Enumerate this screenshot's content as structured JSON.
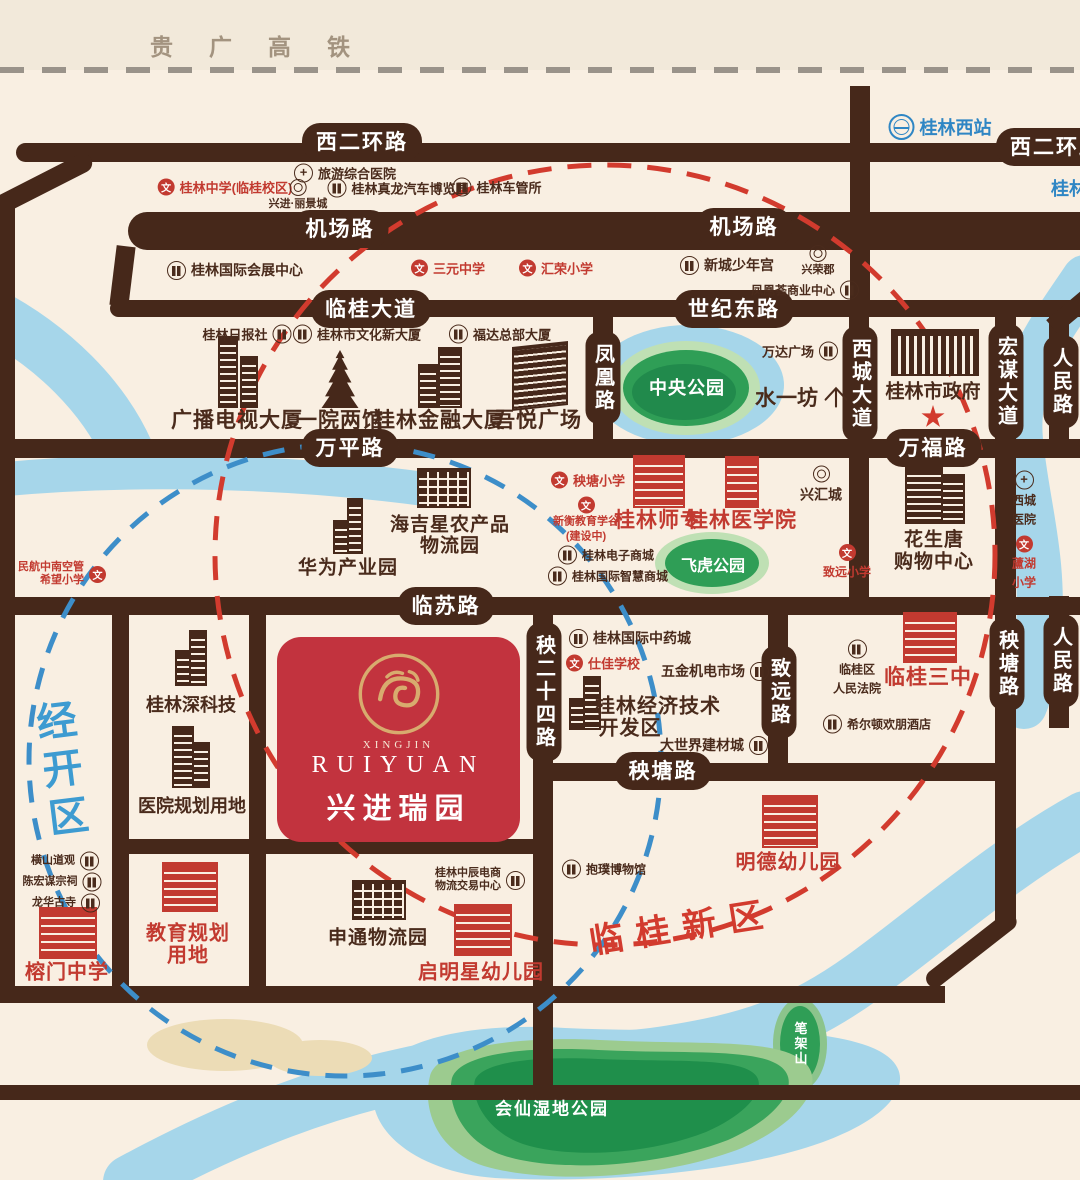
{
  "header": {
    "railway": "贵广高铁"
  },
  "station": {
    "west": "桂林西站",
    "city_clip": "桂林"
  },
  "roads": {
    "xierhuan": "西二环路",
    "xierhuan2": "西二环路",
    "jichang": "机场路",
    "jichang2": "机场路",
    "linguidadao": "临桂大道",
    "shijidong": "世纪东路",
    "wanping": "万平路",
    "wanfu": "万福路",
    "linsu": "临苏路",
    "yangtang": "秧塘路",
    "yangtang_v": "秧塘路",
    "fenghuang": "凤凰路",
    "xichengdadao": "西城大道",
    "hongmoudadao": "宏谋大道",
    "renmin": "人民路",
    "renmin2": "人民路",
    "yang24": "秧二十四路",
    "zhiyuanlu": "致远路"
  },
  "areas": {
    "jingkaiqu": "经开区",
    "linguixinqu": "临桂新区"
  },
  "parks": {
    "zhongyang": "中央公园",
    "feihu": "飞虎公园",
    "bijiashan": "笔架山",
    "huixian": "会仙湿地公园"
  },
  "project": {
    "brand": "XINGJIN",
    "en": "RUIYUAN",
    "zh": "兴进瑞园"
  },
  "pois": {
    "lvyou": "旅游综合医院",
    "guilinzhongxue": "桂林中学(临桂校区)",
    "lijingcheng": "兴进·丽景城",
    "zhenlong": "桂林真龙汽车博览园",
    "cheguansuo": "桂林车管所",
    "huizhan": "桂林国际会展中心",
    "sanyuan": "三元中学",
    "huirong": "汇荣小学",
    "shaoniangong": "新城少年宫",
    "xingrongjun": "兴荣郡",
    "fenghuanghui": "凤凰荟商业中心",
    "ribaoshe": "桂林日报社",
    "wenhua": "桂林市文化新大厦",
    "fuda": "福达总部大厦",
    "guangbo": "广播电视大厦",
    "yiyuan": "一院两馆",
    "jinrong": "桂林金融大厦",
    "wuyue": "吾悦广场",
    "wanda": "万达广场",
    "shuiyifang": "水一坊",
    "zhengfu": "桂林市政府",
    "yangtangxx": "秧塘小学",
    "xinheng1": "新衡教育学谷",
    "xinheng2": "(建设中)",
    "shizhuan": "桂林师专",
    "yixueyuan": "桂林医学院",
    "dianzi": "桂林电子商城",
    "zhihui": "桂林国际智慧商城",
    "xinghuicheng": "兴汇城",
    "zhiyuanxx": "致远小学",
    "huasheng1": "花生唐",
    "huasheng2": "购物中心",
    "xicheng1": "西城",
    "xicheng2": "医院",
    "luhu1": "蘆湖",
    "luhu2": "小学",
    "haijixing1": "海吉星农产品",
    "haijixing2": "物流园",
    "huawei": "华为产业园",
    "minhang1": "民航中南空管",
    "minhang2": "希望小学",
    "zhongyaocheng": "桂林国际中药城",
    "shijia": "仕佳学校",
    "wujin": "五金机电市场",
    "jingji1": "桂林经济技术",
    "jingji2": "开发区",
    "dashijie": "大世界建材城",
    "fayuan1": "临桂区",
    "fayuan2": "人民法院",
    "linguisanzhong": "临桂三中",
    "xierdun": "希尔顿欢朋酒店",
    "shenkeji": "桂林深科技",
    "yiyuanguihua": "医院规划用地",
    "hengshan": "横山道观",
    "chenhongmou": "陈宏谋宗祠",
    "longhua": "龙华古寺",
    "rongmen": "榕门中学",
    "jiaoyu1": "教育规划",
    "jiaoyu2": "用地",
    "mingde": "明德幼儿园",
    "baopu": "抱璞博物馆",
    "shentong": "申通物流园",
    "zhongchen1": "桂林中辰电商",
    "zhongchen2": "物流交易中心",
    "qimingxing": "启明星幼儿园"
  }
}
